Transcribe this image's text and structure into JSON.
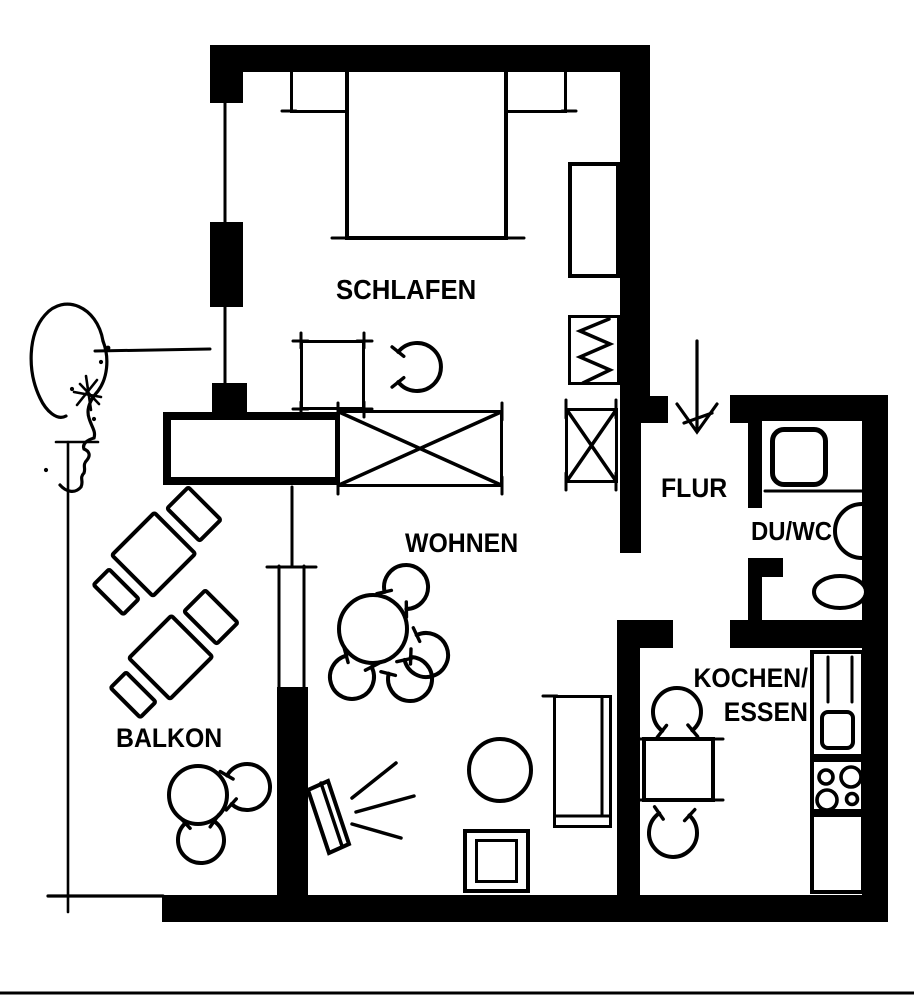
{
  "colors": {
    "ink": "#000000",
    "background": "#ffffff"
  },
  "rooms": {
    "schlafen": {
      "label": "SCHLAFEN"
    },
    "wohnen": {
      "label": "WOHNEN"
    },
    "balkon": {
      "label": "BALKON"
    },
    "flur": {
      "label": "FLUR"
    },
    "duwc": {
      "label": "DU/WC"
    },
    "kochen": {
      "label_line1": "KOCHEN/",
      "label_line2": "ESSEN"
    }
  },
  "fixtures": {
    "bed": "double-bed-icon",
    "nightstands": "nightstand-icon",
    "wardrobe": "wardrobe-icon",
    "coat_rack": "coat-rack-zigzag-icon",
    "crossed_wardrobes": "wardrobe-x-icon",
    "sideboard": "sideboard-icon",
    "dining_table_round": "round-table-icon",
    "chairs": "chair-arc-icon",
    "couch": "couch-icon",
    "tv": "tv-with-beam-icon",
    "stool": "round-stool-icon",
    "side_table": "square-table-icon",
    "kitchen_table": "kitchen-table-icon",
    "sink": "kitchen-sink-icon",
    "stove": "stove-four-burners-icon",
    "shower": "shower-tray-icon",
    "washbasin": "washbasin-icon",
    "wc": "toilet-icon",
    "loungers": "sun-lounger-icon",
    "entrance": "entrance-arrow-icon",
    "figure": "head-profile-sketch-icon"
  }
}
